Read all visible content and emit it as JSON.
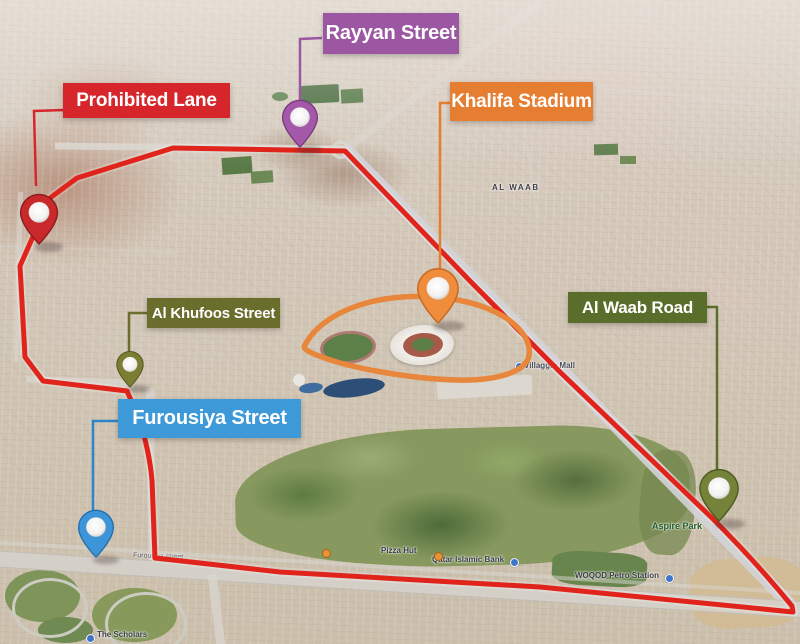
{
  "figure": {
    "type": "annotated-satellite-map",
    "area": "Khalifa Stadium district, Doha"
  },
  "callouts": [
    {
      "id": "rayyan",
      "label": "Rayyan Street",
      "box_color": "#9c57a3",
      "pin_color": "#a458a9"
    },
    {
      "id": "prohibited",
      "label": "Prohibited Lane",
      "box_color": "#d6252b",
      "pin_color": "#c8292a"
    },
    {
      "id": "khalifa",
      "label": "Khalifa Stadium",
      "box_color": "#e67e31",
      "pin_color": "#f08d3c"
    },
    {
      "id": "khufoos",
      "label": "Al Khufoos Street",
      "box_color": "#6b6d2c",
      "pin_color": "#7b7d33"
    },
    {
      "id": "furousiya",
      "label": "Furousiya Street",
      "box_color": "#3e99d8",
      "pin_color": "#3c95d8"
    },
    {
      "id": "alwaab",
      "label": "Al Waab Road",
      "box_color": "#5a6e2c",
      "pin_color": "#75823a"
    }
  ],
  "route": {
    "color": "#e0241c",
    "style": "closed-loop around district"
  },
  "stadium_ring": {
    "color": "#e8863b"
  },
  "map_labels": {
    "al_waab_district": "AL WAAB",
    "aspire_park": "Aspire Park",
    "villaggio_mall": "Villaggio Mall",
    "qatar_islamic_bank": "Qatar Islamic Bank",
    "woqod": "WOQOD Petro Station",
    "pizza_hut": "Pizza Hut",
    "the_scholars": "The Scholars",
    "furousiya_road_text": "Furousiya street"
  }
}
